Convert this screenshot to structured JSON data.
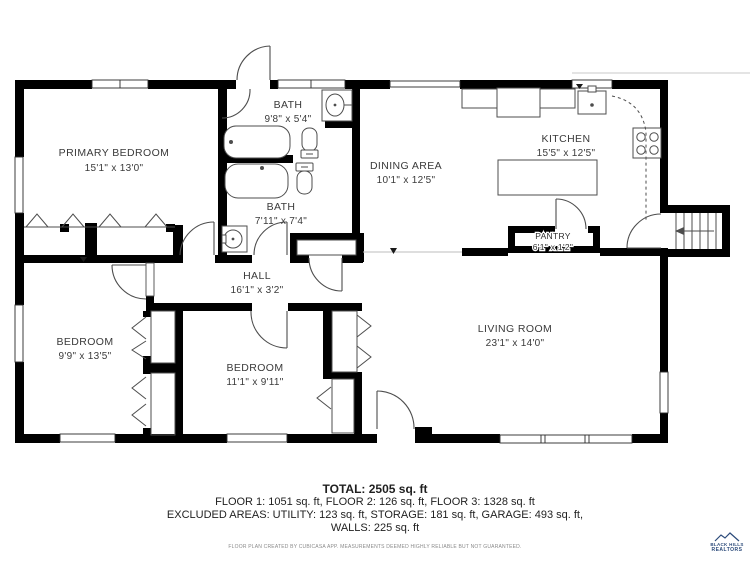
{
  "plan": {
    "rooms": [
      {
        "id": "primary-bedroom",
        "name": "PRIMARY BEDROOM",
        "dims": "15'1\" x 13'0\""
      },
      {
        "id": "bath-upper",
        "name": "BATH",
        "dims": "9'8\" x 5'4\""
      },
      {
        "id": "bath-lower",
        "name": "BATH",
        "dims": "7'11\" x 7'4\""
      },
      {
        "id": "dining-area",
        "name": "DINING AREA",
        "dims": "10'1\" x 12'5\""
      },
      {
        "id": "kitchen",
        "name": "KITCHEN",
        "dims": "15'5\" x 12'5\""
      },
      {
        "id": "pantry",
        "name": "PANTRY",
        "dims": "6'1\" x 1'2\""
      },
      {
        "id": "hall",
        "name": "HALL",
        "dims": "16'1\" x 3'2\""
      },
      {
        "id": "bedroom-left",
        "name": "BEDROOM",
        "dims": "9'9\" x 13'5\""
      },
      {
        "id": "bedroom-middle",
        "name": "BEDROOM",
        "dims": "11'1\" x 9'11\""
      },
      {
        "id": "living-room",
        "name": "LIVING ROOM",
        "dims": "23'1\" x 14'0\""
      }
    ]
  },
  "footer": {
    "total": "TOTAL: 2505 sq. ft",
    "floors": "FLOOR 1: 1051 sq. ft, FLOOR 2: 126 sq. ft, FLOOR 3: 1328 sq. ft",
    "excluded": "EXCLUDED AREAS: UTILITY: 123 sq. ft, STORAGE: 181 sq. ft, GARAGE: 493 sq. ft,",
    "walls": "WALLS: 225 sq. ft",
    "disclaimer": "FLOOR PLAN CREATED BY CUBICASA APP. MEASUREMENTS DEEMED HIGHLY RELIABLE BUT NOT GUARANTEED."
  },
  "logo": {
    "name": "BLACK HILLS",
    "type": "REALTORS"
  }
}
